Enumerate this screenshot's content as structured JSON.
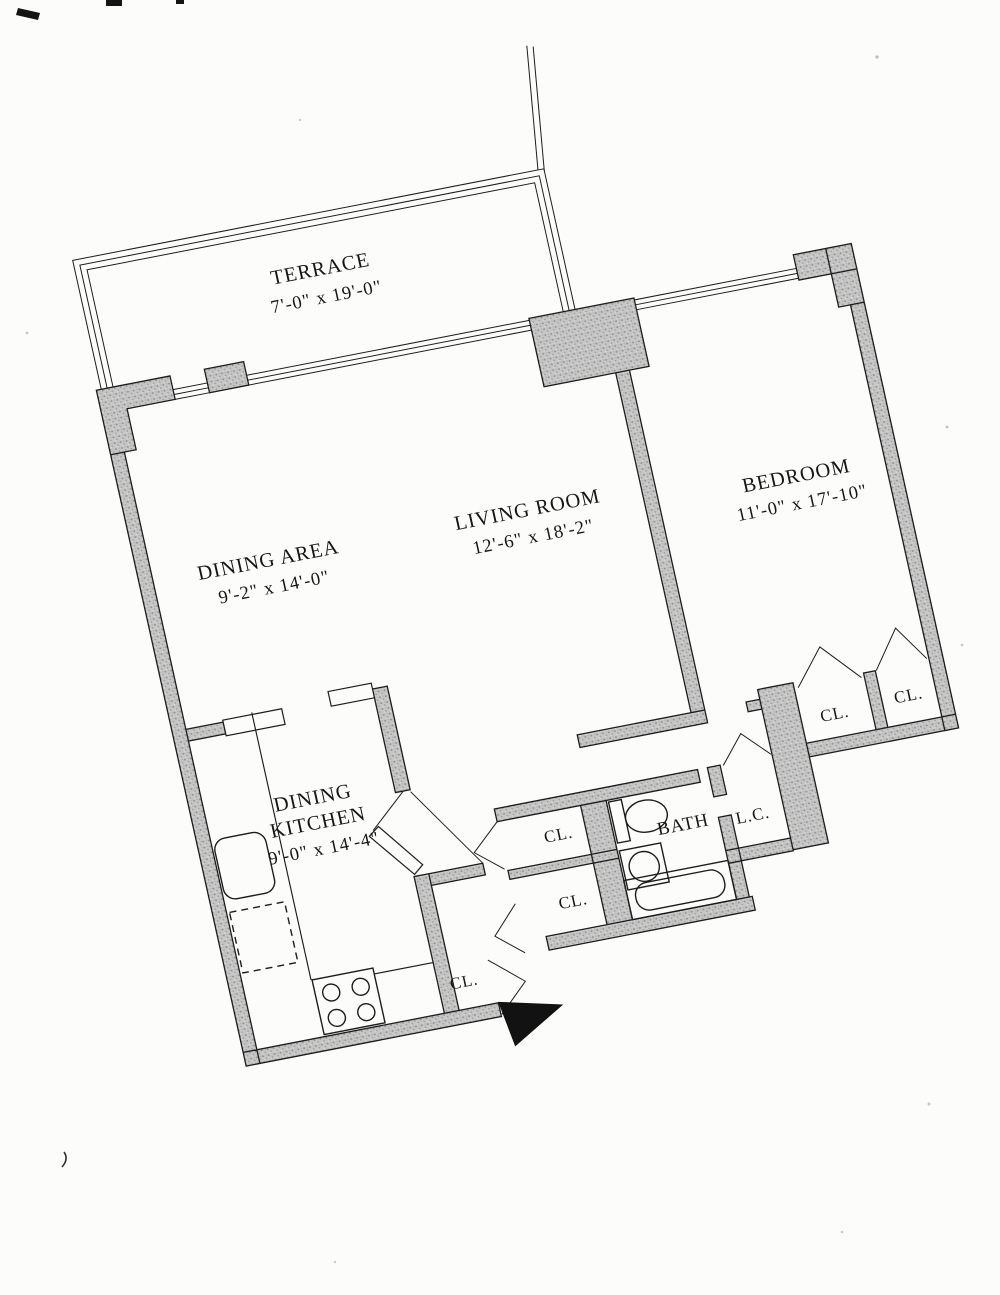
{
  "rooms": {
    "terrace": {
      "label": "TERRACE",
      "dims": "7'-0\" x 19'-0\""
    },
    "dining_area": {
      "label": "DINING AREA",
      "dims": "9'-2\" x 14'-0\""
    },
    "living_room": {
      "label": "LIVING ROOM",
      "dims": "12'-6\" x 18'-2\""
    },
    "bedroom": {
      "label": "BEDROOM",
      "dims": "11'-0\" x 17'-10\""
    },
    "dining_kitchen": {
      "label_line1": "DINING",
      "label_line2": "KITCHEN",
      "dims": "9'-0\" x 14'-4\""
    },
    "bath": {
      "label": "BATH"
    },
    "linen_closet": {
      "label": "L.C."
    }
  },
  "closets": {
    "kitchen": {
      "label": "CL."
    },
    "foyer_upper": {
      "label": "CL."
    },
    "foyer_lower": {
      "label": "CL."
    },
    "bedroom_left": {
      "label": "CL."
    },
    "bedroom_right": {
      "label": "CL."
    }
  },
  "colors": {
    "paper": "#fcfcfa",
    "wall_fill": "#c6c6c6",
    "line": "#1d1d1d",
    "entry_marker": "#121212"
  }
}
